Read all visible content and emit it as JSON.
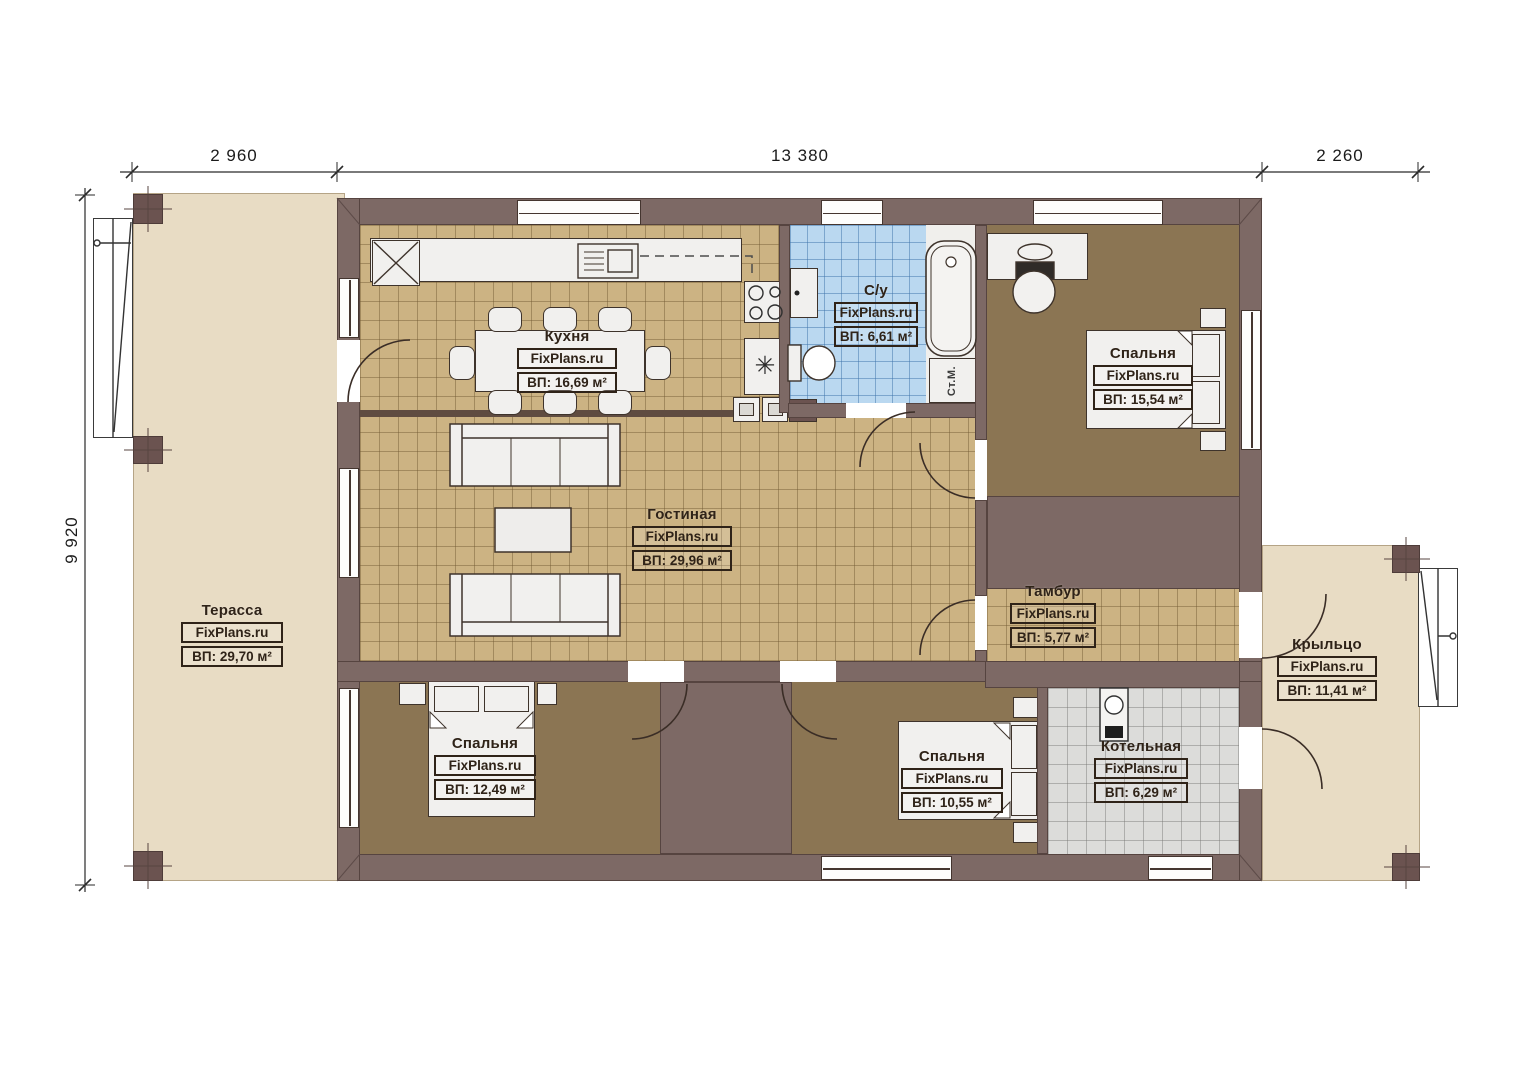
{
  "brand": "FixPlans.ru",
  "dimensions": {
    "top": [
      "2 960",
      "13 380",
      "2 260"
    ],
    "left": "9 920"
  },
  "rooms": {
    "terrace": {
      "name": "Терасса",
      "area": "ВП: 29,70 м²"
    },
    "kitchen": {
      "name": "Кухня",
      "area": "ВП: 16,69 м²"
    },
    "bathroom": {
      "name": "С/у",
      "area": "ВП: 6,61 м²"
    },
    "bedroom_right": {
      "name": "Спальня",
      "area": "ВП: 15,54 м²"
    },
    "living_room": {
      "name": "Гостиная",
      "area": "ВП: 29,96 м²"
    },
    "vestibule": {
      "name": "Тамбур",
      "area": "ВП: 5,77 м²"
    },
    "porch": {
      "name": "Крыльцо",
      "area": "ВП: 11,41 м²"
    },
    "bedroom_left": {
      "name": "Спальня",
      "area": "ВП: 12,49 м²"
    },
    "bedroom_middle": {
      "name": "Спальня",
      "area": "ВП: 10,55 м²"
    },
    "boiler_room": {
      "name": "Котельная",
      "area": "ВП: 6,29 м²"
    }
  },
  "fixtures": {
    "washing_machine_label": "Ст.М."
  },
  "icons": {
    "fridge_snowflake_icon": "✳"
  },
  "colors": {
    "wall": "#7d6965",
    "floor_tile_tan": "#ccb383",
    "floor_bedroom": "#8b7553",
    "floor_bathroom": "#bad8f0",
    "floor_boiler": "#dcdcda",
    "outdoor_deck": "#e8dcc4"
  }
}
